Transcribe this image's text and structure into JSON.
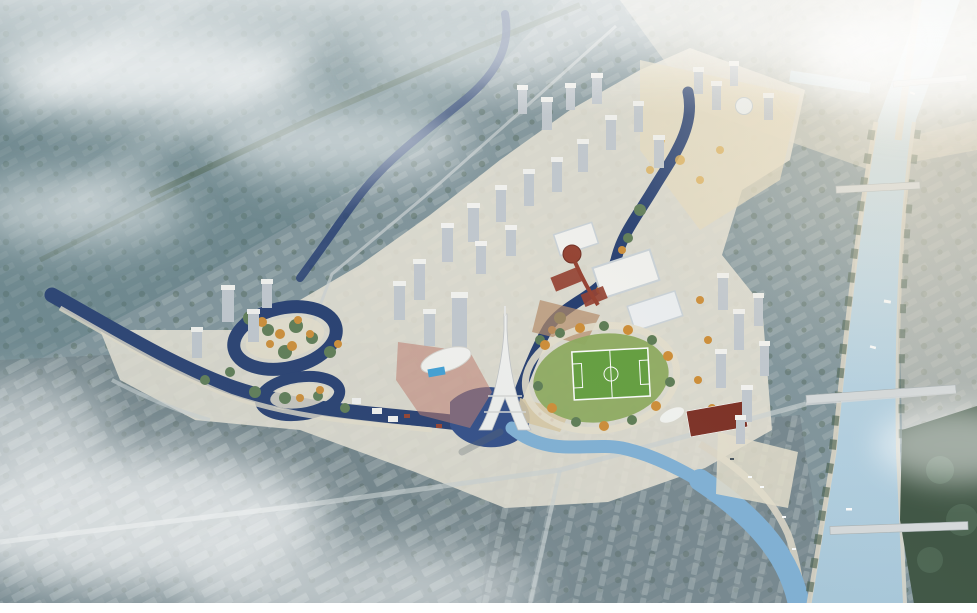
{
  "image": {
    "type": "architectural-aerial-rendering",
    "description": "Aerial bird's-eye rendering of a riverside urban redevelopment masterplan: dark navy canals wind through an autumn-colored central park, an Eiffel-style observation tower and clusters of white high-rise towers line the new district, an oval park contains a green soccer field, red-roofed commercial buildings sit at the center, and a wide light-blue river crossed by several bridges borders the site on the east, all surrounded by misty blue-gray city fabric fading to white haze at the edges."
  },
  "palette": {
    "fabric-base": "#7f939a",
    "fabric-teal": "#4e7077",
    "fabric-gray": "#5f6b70",
    "slab-light": "#aab6b8",
    "tree-green": "#3f5743",
    "tree-green2": "#5c7a52",
    "tree-orange": "#cf8c33",
    "tree-gold": "#dfae52",
    "water-dark": "#223a6e",
    "water-mid": "#2e4a86",
    "canal-light": "#7fb0d6",
    "river-light": "#cfe3ee",
    "river-deep": "#a9c9dc",
    "dev-ground": "#e9e4d6",
    "bldg-roof": "#f5f4f1",
    "bldg-side": "#c2c8cf",
    "roof-red": "#943d2c",
    "roof-darkred": "#7c2d21",
    "plaza-red": "#c07a6b",
    "plaza-brown": "#b58a66",
    "mall-roof": "#ccd3d8",
    "pitch-green": "#639e3c",
    "park-lawn": "#8caa5c",
    "ring-path": "#e6dfcc",
    "road-light": "#ccd2d3",
    "road-beige": "#ddd6c6",
    "haze-warm": "#f4e9d4",
    "trees-dark": "#3c5240",
    "bridge-gray": "#d8dbdc",
    "pool-blue": "#3e9fd6",
    "sand": "#d9c9a4",
    "mist": "#ffffff"
  }
}
